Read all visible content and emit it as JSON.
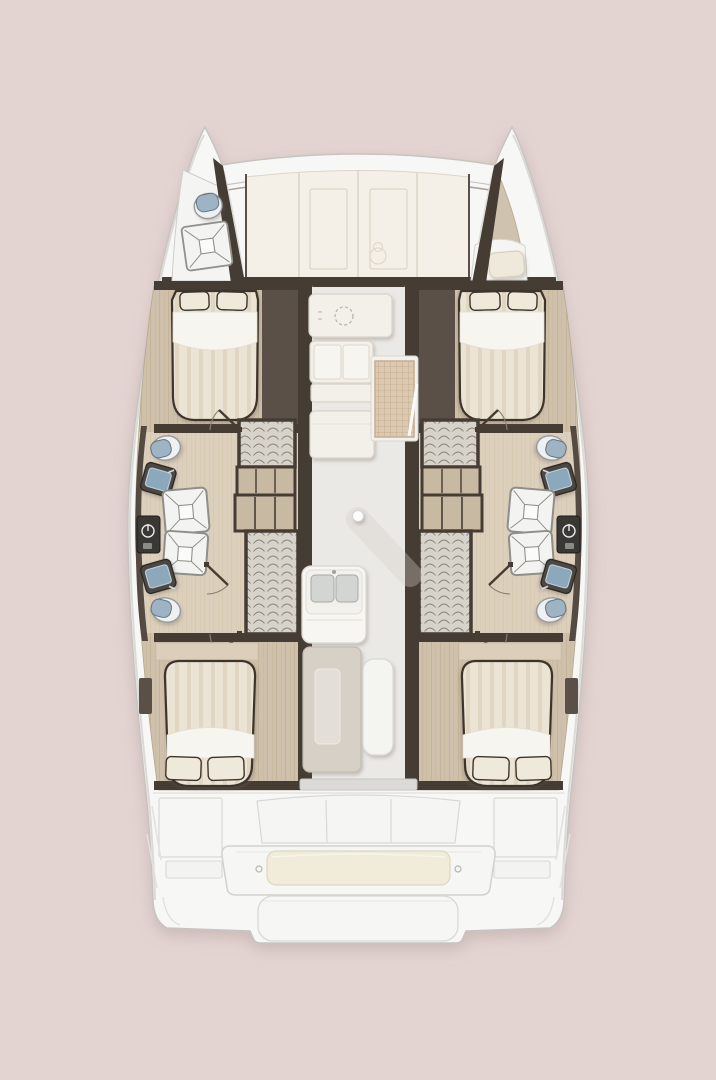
{
  "scene": {
    "type": "yacht-floorplan",
    "view": "top-down",
    "vessel": "catamaran",
    "hulls": 2,
    "cabins": 4,
    "bathrooms": 4
  },
  "palette": {
    "background": "#e3d4d2",
    "hull_white": "#f7f8f6",
    "hull_edge": "#c7c4c0",
    "deck_line": "#dbdad7",
    "panel_cream": "#f5f0e7",
    "panel_line": "#ddd5c6",
    "trim_brown": "#9b8a82",
    "wall_dark": "#453c34",
    "wall_mid": "#5a5048",
    "wood": "#cfc0ab",
    "wood_grain": "#bba986",
    "wood_light": "#dbcfba",
    "bath_overlay": "#ece3d0",
    "saloon_floor": "#ebe9e5",
    "floor_shadow": "#d6cec7",
    "locker_gray": "#d7d3ca",
    "locker_arc": "#7b7469",
    "drawer_tan": "#c8b9a2",
    "duvet": "#ebe3d3",
    "duvet_stripe": "#e0d6c2",
    "sheet_white": "#f7f5ef",
    "pillow": "#efe9db",
    "outline_dark": "#3c342c",
    "toilet_body": "#eef0f1",
    "toilet_lid": "#9eb3c3",
    "sink_dark": "#4c4742",
    "sink_basin": "#8ca8bd",
    "shower_white": "#f3f4f2",
    "shower_line": "#91908b",
    "appliance_dark": "#3a3835",
    "counter_white": "#f3f0e9",
    "counter_line": "#d8d4ca",
    "mat_tan": "#dcc9b1",
    "mat_line": "#bda286",
    "table_top": "#d6d0c7",
    "table_inset": "#e3dfd8",
    "bench_white": "#f4f4f1",
    "cushion_cream": "#f1ebda",
    "cockpit_white": "#f6f7f5",
    "cockpit_line": "#d9d8d4",
    "door_arc": "#8a7f72",
    "door_leaf": "#473c31",
    "berth_tan": "#cfc2ae"
  },
  "areas": {
    "forward_lounge": {
      "name": "forward-lounge",
      "panels": 4
    },
    "port_bow_head": {
      "name": "port-bow-head",
      "fixtures": [
        "toilet",
        "shower-tray"
      ]
    },
    "starboard_bow_berth": {
      "name": "starboard-bow-berth",
      "fixtures": [
        "seat-cushion"
      ]
    },
    "port_hull": {
      "cabins": [
        {
          "name": "forward-cabin",
          "fixtures": [
            "double-bed",
            "pillow",
            "pillow",
            "wardrobe"
          ]
        },
        {
          "name": "bathroom",
          "fixtures": [
            "toilet",
            "washbasin",
            "shower-tray",
            "shower-tray",
            "washing-machine",
            "washbasin",
            "toilet",
            "hanging-locker",
            "shelf-unit",
            "drawer-unit",
            "hanging-locker"
          ]
        },
        {
          "name": "aft-cabin",
          "fixtures": [
            "double-bed",
            "pillow",
            "pillow"
          ]
        }
      ]
    },
    "starboard_hull": {
      "mirror_of": "port_hull"
    },
    "galley": {
      "fixtures": [
        "sink-counter",
        "cooktop",
        "drawer-counter",
        "refrigerator-counter",
        "companionway-steps"
      ]
    },
    "saloon": {
      "fixtures": [
        "support-pole",
        "island-double-sink",
        "dining-table",
        "bench"
      ]
    },
    "aft_cockpit": {
      "fixtures": [
        "side-panel",
        "window-band",
        "bench-seat",
        "seat-cushion",
        "swim-steps",
        "side-panel"
      ]
    }
  }
}
